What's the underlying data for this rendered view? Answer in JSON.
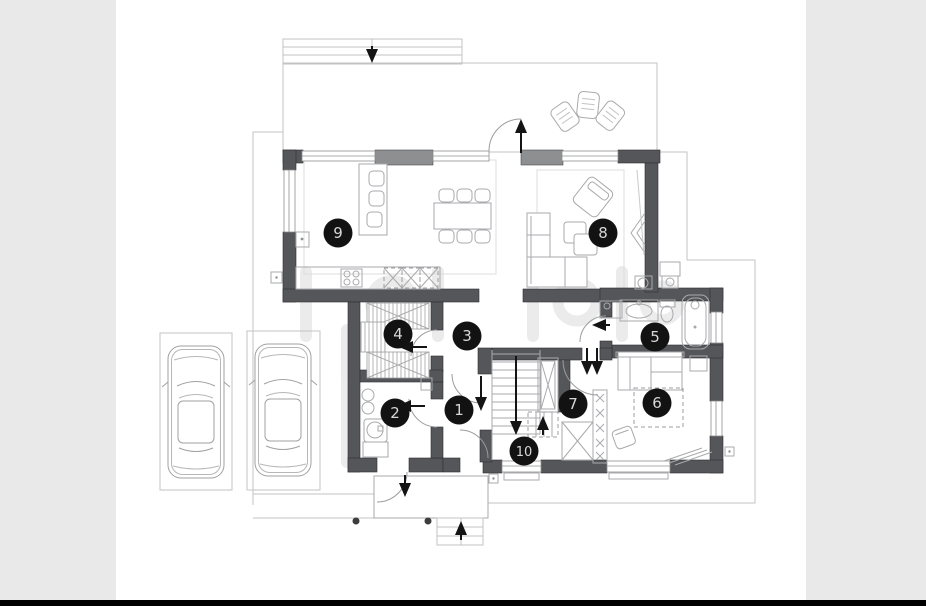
{
  "viewer": {
    "background_color": "#ffffff",
    "matte_color": "#e9e9e9",
    "bottom_bar_color": "#000000"
  },
  "floor_plan": {
    "type": "architectural-floor-plan",
    "wall_color": "#55565a",
    "window_pier_color": "#8d8f91",
    "thin_line_color": "#a9aaac",
    "site_line_color": "#c3c3c3",
    "marker_style": {
      "fill": "#121212",
      "text_color": "#d6d7d8"
    },
    "markers": [
      {
        "label": "1"
      },
      {
        "label": "2"
      },
      {
        "label": "3"
      },
      {
        "label": "4"
      },
      {
        "label": "5"
      },
      {
        "label": "6"
      },
      {
        "label": "7"
      },
      {
        "label": "8"
      },
      {
        "label": "9"
      },
      {
        "label": "10"
      }
    ]
  }
}
